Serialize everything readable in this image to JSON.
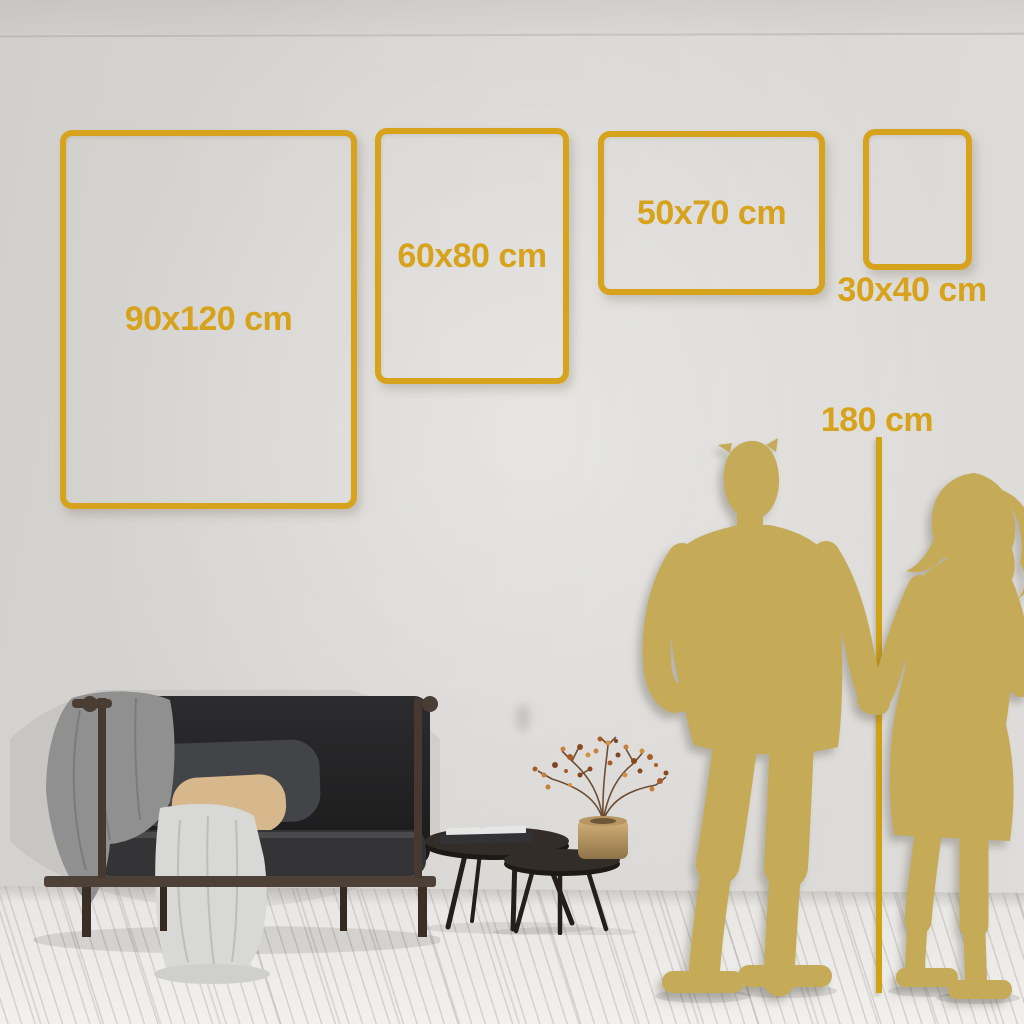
{
  "size_guide": {
    "frames": [
      {
        "label": "90x120 cm",
        "orientation": "portrait",
        "label_placement": "inside"
      },
      {
        "label": "60x80 cm",
        "orientation": "portrait",
        "label_placement": "inside"
      },
      {
        "label": "50x70 cm",
        "orientation": "landscape",
        "label_placement": "inside"
      },
      {
        "label": "30x40 cm",
        "orientation": "portrait",
        "label_placement": "below"
      }
    ],
    "height_marker": {
      "label": "180 cm"
    }
  },
  "colors": {
    "accent_gold": "#d7a31c",
    "marker_line_gold": "#d2a215",
    "silhouette_gold": "#c5aa57",
    "wall": "#d8d6d3",
    "floor": "#efeeec",
    "sofa_dark": "#232324",
    "pillow_tan": "#d7b78c",
    "vase_gold": "#c2a269"
  },
  "scene_objects": [
    "sofa",
    "gray-blanket",
    "white-throw-blanket",
    "beige-pillow",
    "gray-back-cushion",
    "nesting-coffee-tables",
    "books-stack",
    "gold-vase",
    "dried-branch-with-berries",
    "man-silhouette",
    "woman-silhouette",
    "couple-holding-hands"
  ]
}
